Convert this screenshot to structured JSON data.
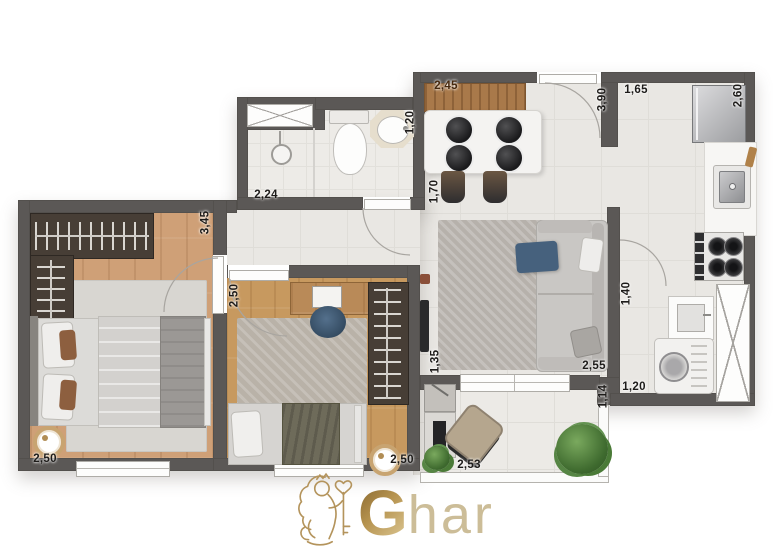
{
  "plan": {
    "dimensions": [
      {
        "id": "dining-width",
        "value": "2,45"
      },
      {
        "id": "kitchen-length",
        "value": "3,90"
      },
      {
        "id": "kitchen-entry",
        "value": "1,65"
      },
      {
        "id": "fridge-wall",
        "value": "2,60"
      },
      {
        "id": "bath-width",
        "value": "1,20"
      },
      {
        "id": "shower-width",
        "value": "2,24"
      },
      {
        "id": "master-length",
        "value": "3,45"
      },
      {
        "id": "dining-depth",
        "value": "1,70"
      },
      {
        "id": "bedroom2-width",
        "value": "2,50"
      },
      {
        "id": "kitchen-width",
        "value": "1,40"
      },
      {
        "id": "living-depth",
        "value": "1,35"
      },
      {
        "id": "living-width",
        "value": "2,55"
      },
      {
        "id": "service-width",
        "value": "1,20"
      },
      {
        "id": "balcony-depth",
        "value": "1,14"
      },
      {
        "id": "master-width",
        "value": "2,50"
      },
      {
        "id": "bedroom2-bottom",
        "value": "2,50"
      },
      {
        "id": "balcony-width",
        "value": "2,53"
      }
    ]
  },
  "logo": {
    "initial": "G",
    "rest": "har"
  },
  "colors": {
    "wall": "#5b5856",
    "wood_floor": "#cfa077",
    "tile_floor": "#e9e7e3",
    "label": "#1d1b19",
    "label_on_wood": "#45280e",
    "logo_gold": "#b6934f",
    "logo_gold_light": "#ccbd98",
    "accent_blue": "#46617d",
    "plant_green": "#4a7a37"
  }
}
